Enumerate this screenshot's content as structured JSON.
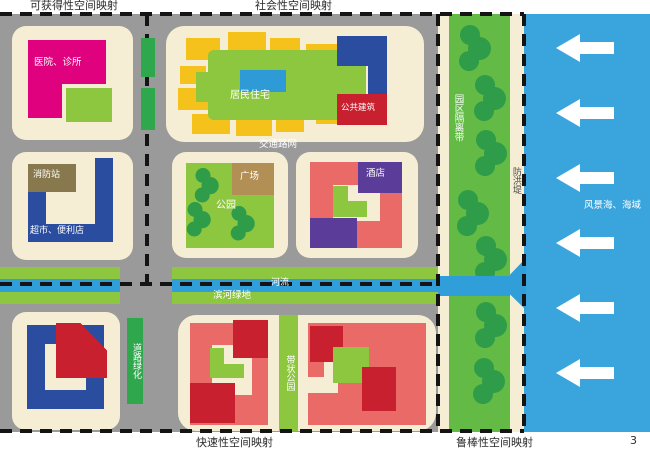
{
  "page": {
    "number": "3"
  },
  "quadrant_labels": {
    "top_left": "可获得性空间映射",
    "top_right": "社会性空间映射",
    "bottom_left": "快速性空间映射",
    "bottom_right": "鲁棒性空间映射"
  },
  "map_labels": {
    "hospital": "医院、诊所",
    "residential": "居民住宅",
    "public_building": "公共建筑",
    "road_network": "交通路网",
    "fire_station": "消防站",
    "supermarket": "超市、便利店",
    "plaza": "广场",
    "park": "公园",
    "hotel": "酒店",
    "river": "河流",
    "riverside_green": "滨河绿地",
    "road_greening": "道路绿化",
    "linear_park": "带状公园",
    "green_belt": "园区隔离带",
    "dike": "防洪堤",
    "sea": "风景海、海域"
  },
  "icons": {
    "tree-icon": "circle-cluster",
    "left-arrow-icon": "◀"
  },
  "colors": {
    "gray": "#9a9a9a",
    "cream": "#f6eed4",
    "magenta": "#e0017e",
    "green": "#8dc63f",
    "mid_green": "#2fa74d",
    "belt_green": "#63bb45",
    "tree_green": "#2e9c48",
    "dark_blue": "#2a4da0",
    "olive": "#87794d",
    "tan": "#b28f55",
    "salmon": "#e96a67",
    "dark_red": "#c8202f",
    "purple": "#5c3c99",
    "yellow": "#f5c21c",
    "center_blue": "#2e9bd6",
    "river_blue": "#2f9ed9",
    "sea_blue": "#3aa4dc",
    "dash": "#141414"
  }
}
